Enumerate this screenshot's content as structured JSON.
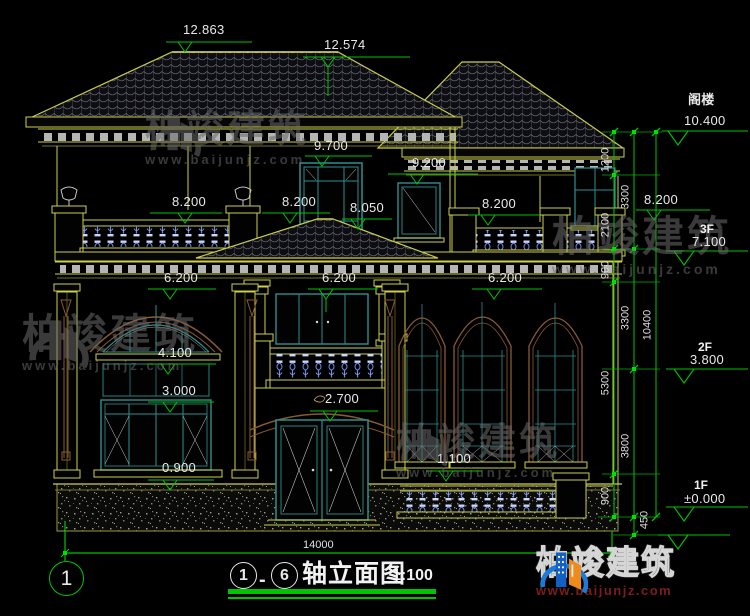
{
  "watermark": {
    "brand": "柏竣建筑",
    "url": "www.baijunjz.com"
  },
  "logo": {
    "brand": "柏竣建筑",
    "url": "www.baijunjz.com"
  },
  "title_block": {
    "axis_start": "1",
    "separator": "-",
    "axis_end": "6",
    "title": "轴立面图",
    "scale": "1:100"
  },
  "axis_bubble": {
    "label": "1"
  },
  "dimensions": {
    "total_width": "14000",
    "chain": {
      "c1200": "1200",
      "c2100": "2100",
      "c900a": "900",
      "c5300": "5300",
      "c900b": "900",
      "c3300a": "3300",
      "c3300b": "3300",
      "c3800": "3800",
      "c10400": "10400",
      "c450": "450"
    }
  },
  "levels": {
    "attic_name": "阁楼",
    "attic_value": "10.400",
    "f3_name": "3F",
    "f3_value": "7.100",
    "f2_name": "2F",
    "f2_value": "3.800",
    "f1_name": "1F",
    "f1_value": "±0.000"
  },
  "elevations": {
    "e12863": "12.863",
    "e12574": "12.574",
    "e9700": "9.700",
    "e9200": "9.200",
    "e8200a": "8.200",
    "e8200b": "8.200",
    "e8050": "8.050",
    "e8200c": "8.200",
    "e8200d": "8.200",
    "e6200a": "6.200",
    "e6200b": "6.200",
    "e6200c": "6.200",
    "e4100": "4.100",
    "e3000": "3.000",
    "e0900": "0.900",
    "e2700": "2.700",
    "e1100": "1.100"
  }
}
